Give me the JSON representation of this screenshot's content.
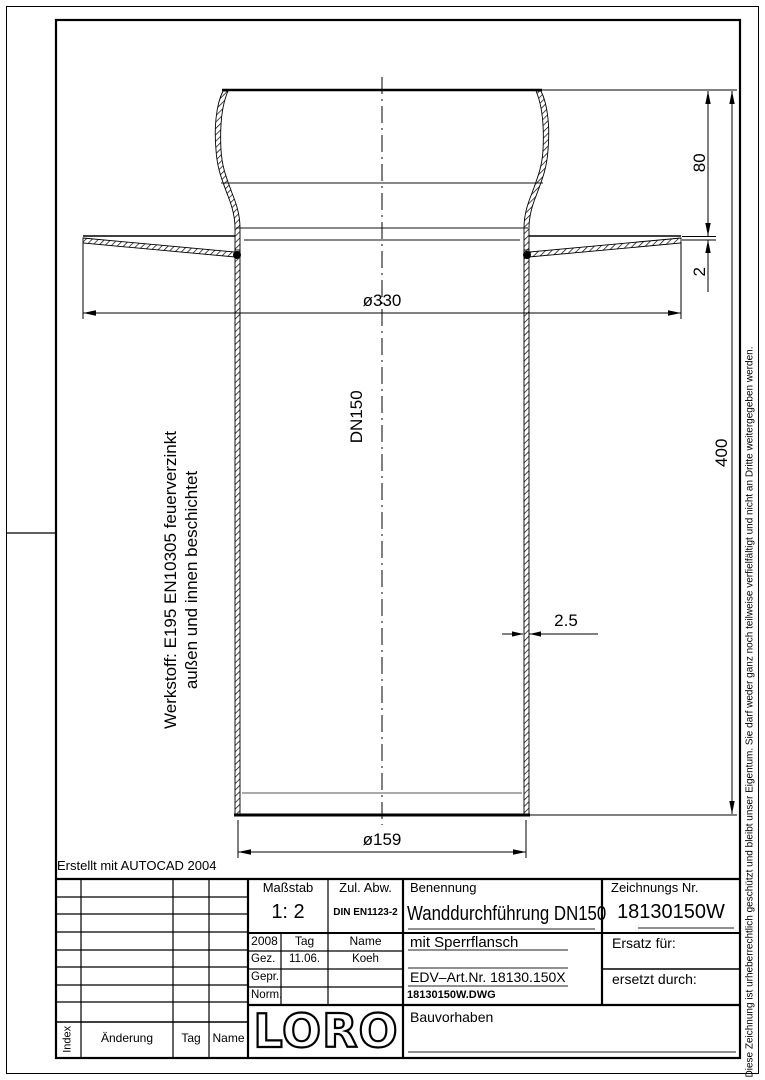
{
  "frame": {
    "created_note": "Erstellt mit AUTOCAD 2004",
    "copyright": "Diese Zeichnung ist urheberrechtlich geschützt und bleibt unser Eigentum. Sie darf weder ganz noch teilweise verfielfältigt und nicht an Dritte weitergegeben werden."
  },
  "drawing": {
    "material_line1": "Werkstoff: E195 EN10305 feuerverzinkt",
    "material_line2": "außen und innen beschichtet",
    "labels": {
      "nominal_size": "DN150"
    },
    "dimensions": {
      "flange_outer_dia": "ø330",
      "pipe_outer_dia": "ø159",
      "socket_height": "80",
      "flange_thickness": "2",
      "total_length": "400",
      "wall_thickness": "2.5"
    }
  },
  "title_block": {
    "revision": {
      "col_index": "Index",
      "col_change": "Änderung",
      "col_date": "Tag",
      "col_name": "Name"
    },
    "scale": {
      "label": "Maßstab",
      "value": "1: 2"
    },
    "tolerance": {
      "label": "Zul. Abw.",
      "value": "DIN EN1123-2"
    },
    "approval": {
      "year": "2008",
      "col_date": "Tag",
      "col_name": "Name",
      "rows": [
        {
          "label": "Gez.",
          "date": "11.06.",
          "name": "Koeh"
        },
        {
          "label": "Gepr.",
          "date": "",
          "name": ""
        },
        {
          "label": "Norm.",
          "date": "",
          "name": ""
        }
      ]
    },
    "name": {
      "label": "Benennung",
      "value": "Wanddurchführung DN150",
      "subtitle": "mit Sperrflansch"
    },
    "drawing_no": {
      "label": "Zeichnungs Nr.",
      "value": "18130150W"
    },
    "edv_art_no": "EDV–Art.Nr. 18130.150X",
    "file_name": "18130150W.DWG",
    "replacement_for": "Ersatz für:",
    "replaced_by": "ersetzt durch:",
    "project": "Bauvorhaben",
    "logo": "LORO"
  }
}
